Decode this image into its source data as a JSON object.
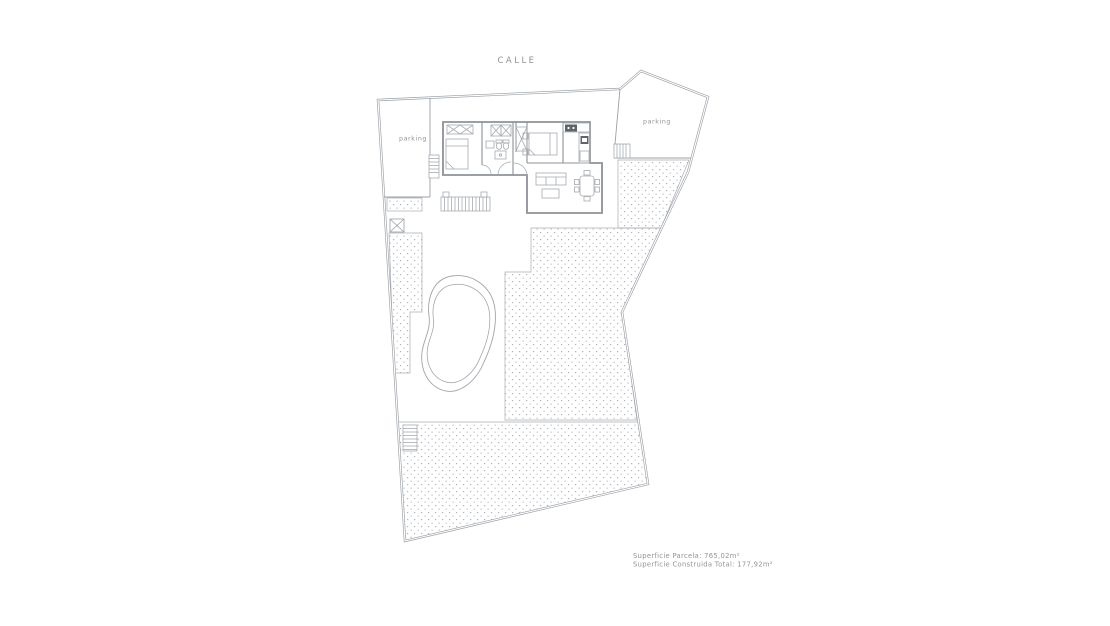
{
  "street_label": "CALLE",
  "parking": {
    "left_label": "parking",
    "right_label": "parking"
  },
  "summary": {
    "line1": "Superficie Parcela: 765,02m²",
    "line2": "Superficie Construida Total: 177,92m²"
  },
  "colors": {
    "background": "#ffffff",
    "boundary_line": "#9aa0a6",
    "wall_line": "#8d9298",
    "furniture_line": "#a5aab0",
    "hatch_dot": "#a8adb3",
    "text": "#8f9499",
    "appliance_dark": "#5f6468"
  }
}
